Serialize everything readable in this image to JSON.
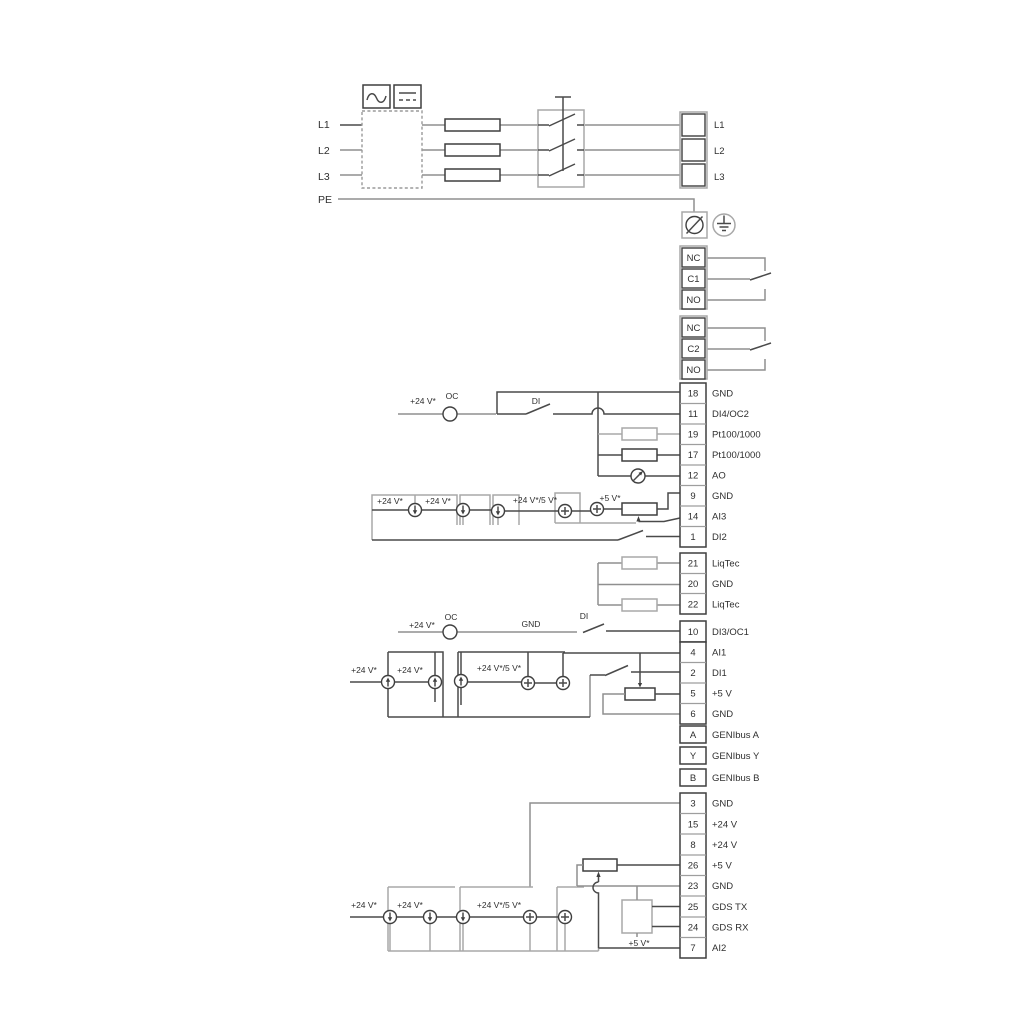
{
  "colors": {
    "background": "#ffffff",
    "wire_gray": "#8f8f8f",
    "line_dark": "#4a4a4a",
    "component_gray": "#a8a8a8",
    "text": "#2f2f2f"
  },
  "power_in": {
    "l1": "L1",
    "l2": "L2",
    "l3": "L3",
    "pe": "PE"
  },
  "power_out": {
    "l1": "L1",
    "l2": "L2",
    "l3": "L3"
  },
  "relay1": {
    "nc": "NC",
    "c": "C1",
    "no": "NO"
  },
  "relay2": {
    "nc": "NC",
    "c": "C2",
    "no": "NO"
  },
  "io_strip": [
    {
      "n": "18",
      "l": "GND"
    },
    {
      "n": "11",
      "l": "DI4/OC2"
    },
    {
      "n": "19",
      "l": "Pt100/1000"
    },
    {
      "n": "17",
      "l": "Pt100/1000"
    },
    {
      "n": "12",
      "l": "AO"
    },
    {
      "n": "9",
      "l": "GND"
    },
    {
      "n": "14",
      "l": "AI3"
    },
    {
      "n": "1",
      "l": "DI2"
    }
  ],
  "liqtec_strip": [
    {
      "n": "21",
      "l": "LiqTec"
    },
    {
      "n": "20",
      "l": "GND"
    },
    {
      "n": "22",
      "l": "LiqTec"
    }
  ],
  "di3_strip": [
    {
      "n": "10",
      "l": "DI3/OC1"
    }
  ],
  "ai1_strip": [
    {
      "n": "4",
      "l": "AI1"
    },
    {
      "n": "2",
      "l": "DI1"
    },
    {
      "n": "5",
      "l": "+5 V"
    },
    {
      "n": "6",
      "l": "GND"
    }
  ],
  "genibus_strip": [
    {
      "n": "A",
      "l": "GENIbus A"
    },
    {
      "n": "Y",
      "l": "GENIbus Y"
    },
    {
      "n": "B",
      "l": "GENIbus B"
    }
  ],
  "bottom_strip": [
    {
      "n": "3",
      "l": "GND"
    },
    {
      "n": "15",
      "l": "+24 V"
    },
    {
      "n": "8",
      "l": "+24 V"
    },
    {
      "n": "26",
      "l": "+5 V"
    },
    {
      "n": "23",
      "l": "GND"
    },
    {
      "n": "25",
      "l": "GDS TX"
    },
    {
      "n": "24",
      "l": "GDS RX"
    },
    {
      "n": "7",
      "l": "AI2"
    }
  ],
  "ann": {
    "oc": "OC",
    "di": "DI",
    "gnd": "GND",
    "v24": "+24 V*",
    "v24_5": "+24 V*/5 V*",
    "v5": "+5 V*"
  }
}
